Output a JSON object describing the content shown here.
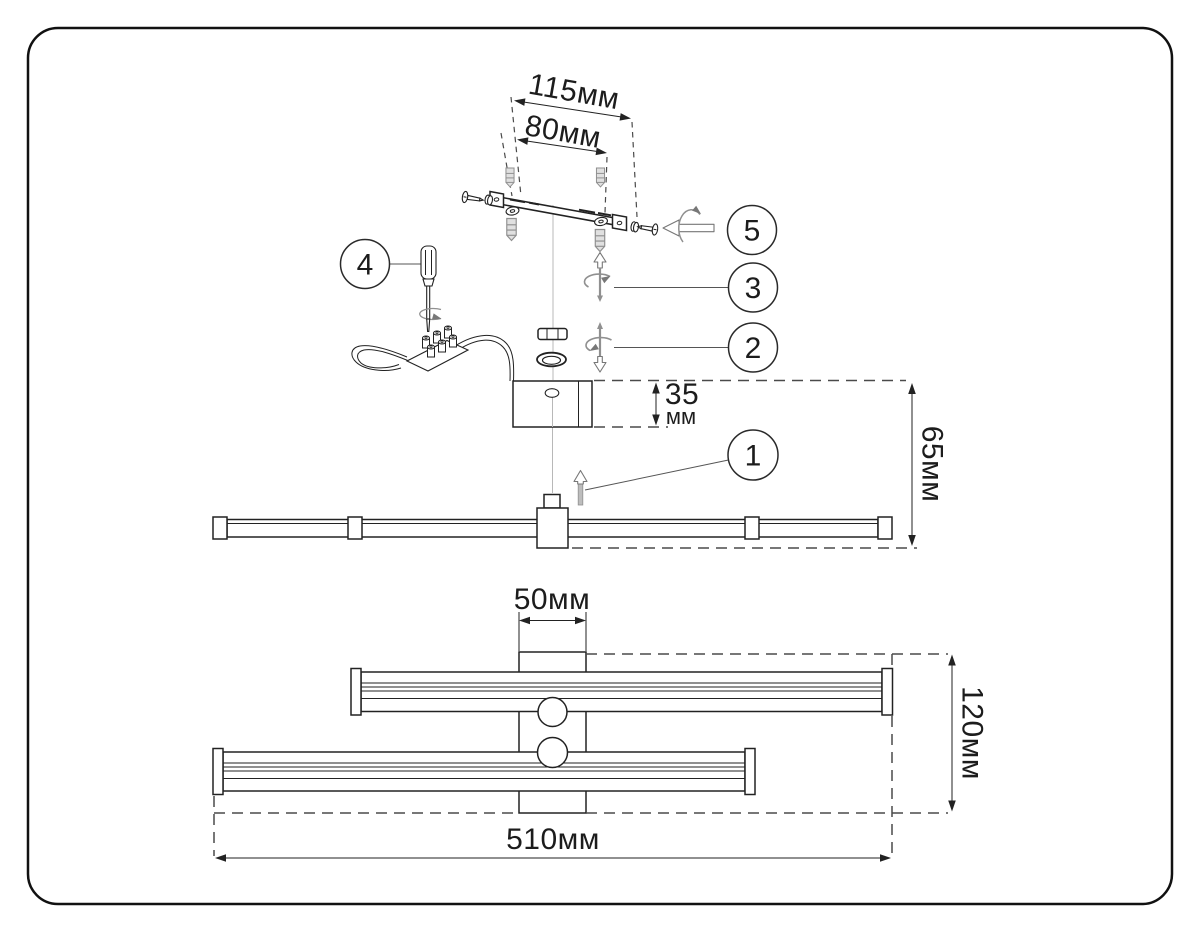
{
  "diagram": {
    "type": "light-fixture-assembly-instruction",
    "colors": {
      "line": "#222222",
      "gray_part": "#909090",
      "background": "#ffffff"
    },
    "dimensions": {
      "bracket_outer": "115мм",
      "bracket_holes": "80мм",
      "canopy_height_value": "35",
      "canopy_height_unit": "мм",
      "mount_depth": "65мм",
      "plate_width": "50мм",
      "total_length": "510мм",
      "total_height": "120мм"
    },
    "steps": {
      "step1": "1",
      "step2": "2",
      "step3": "3",
      "step4": "4",
      "step5": "5"
    }
  }
}
